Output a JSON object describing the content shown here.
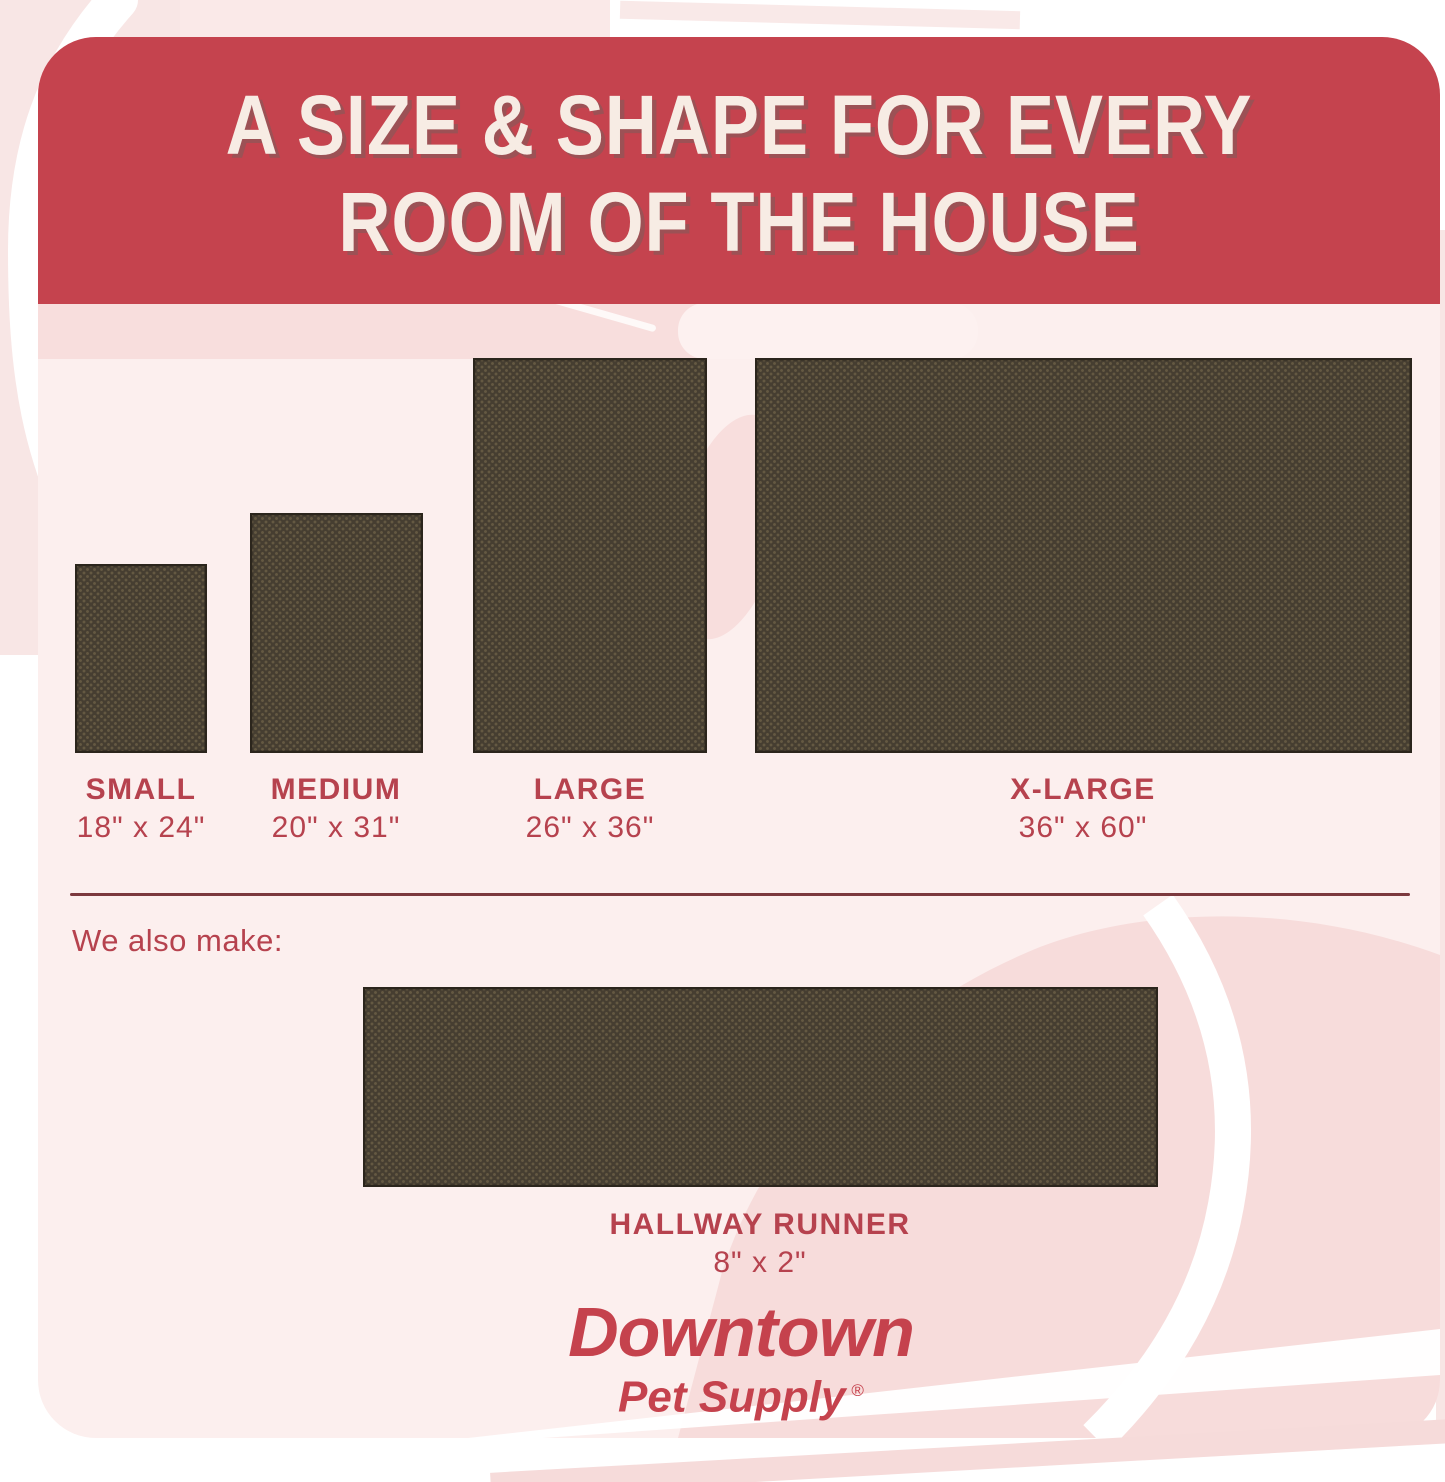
{
  "header": {
    "line1": "A SIZE & SHAPE FOR EVERY",
    "line2": "ROOM OF THE HOUSE"
  },
  "sizes": [
    {
      "name": "SMALL",
      "dimensions": "18\" x 24\""
    },
    {
      "name": "MEDIUM",
      "dimensions": "20\" x 31\""
    },
    {
      "name": "LARGE",
      "dimensions": "26\" x 36\""
    },
    {
      "name": "X-LARGE",
      "dimensions": "36\" x 60\""
    }
  ],
  "also_make": {
    "label": "We also make:",
    "item": {
      "name": "HALLWAY RUNNER",
      "dimensions": "8\" x 2\""
    }
  },
  "brand": {
    "name": "Downtown",
    "tagline": "Pet Supply",
    "registered": "®"
  },
  "colors": {
    "banner_red": "#c5434e",
    "heading_cream": "#f7ece4",
    "label_red": "#b6424e",
    "divider_maroon": "#7c393e",
    "rug_brown": "#463e31",
    "card_pink": "#fcefee",
    "swirl_pink": "#f8dedd",
    "blob_pink": "#f7dcdb",
    "outer_pink": "#f8e6e5"
  }
}
